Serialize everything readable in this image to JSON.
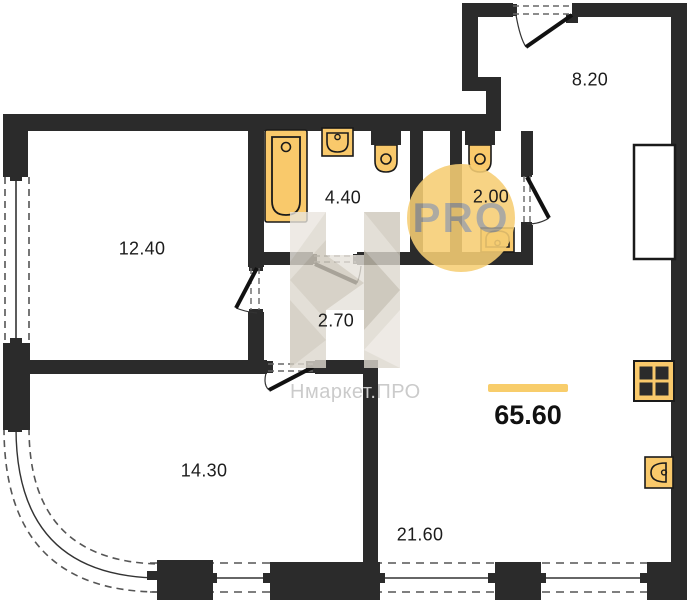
{
  "brand": {
    "badge_text": "PRO",
    "watermark_text": "Нмаркет.ПРО"
  },
  "plan": {
    "total_area": "65.60",
    "rooms": [
      {
        "id": "hallway",
        "area": "8.20"
      },
      {
        "id": "bathroom",
        "area": "4.40"
      },
      {
        "id": "wc",
        "area": "2.00"
      },
      {
        "id": "bedroom",
        "area": "12.40"
      },
      {
        "id": "corridor",
        "area": "2.70"
      },
      {
        "id": "bedroom-2",
        "area": "14.30"
      },
      {
        "id": "living-kitchen",
        "area": "21.60"
      }
    ],
    "fixtures": [
      "bathtub",
      "sink",
      "toilet",
      "toilet",
      "sink",
      "stove",
      "kitchen-sink",
      "vent-shaft"
    ]
  },
  "colors": {
    "wall": "#2b2b2b",
    "fixture": "#f9c96b",
    "fixture-line": "#1a1a1a",
    "accent": "#f8cd6b",
    "badge-bg": "#f6ce74",
    "badge-text": "#9a9a9a",
    "watermark": "#d9d3c9",
    "label": "#1c1c1c"
  }
}
